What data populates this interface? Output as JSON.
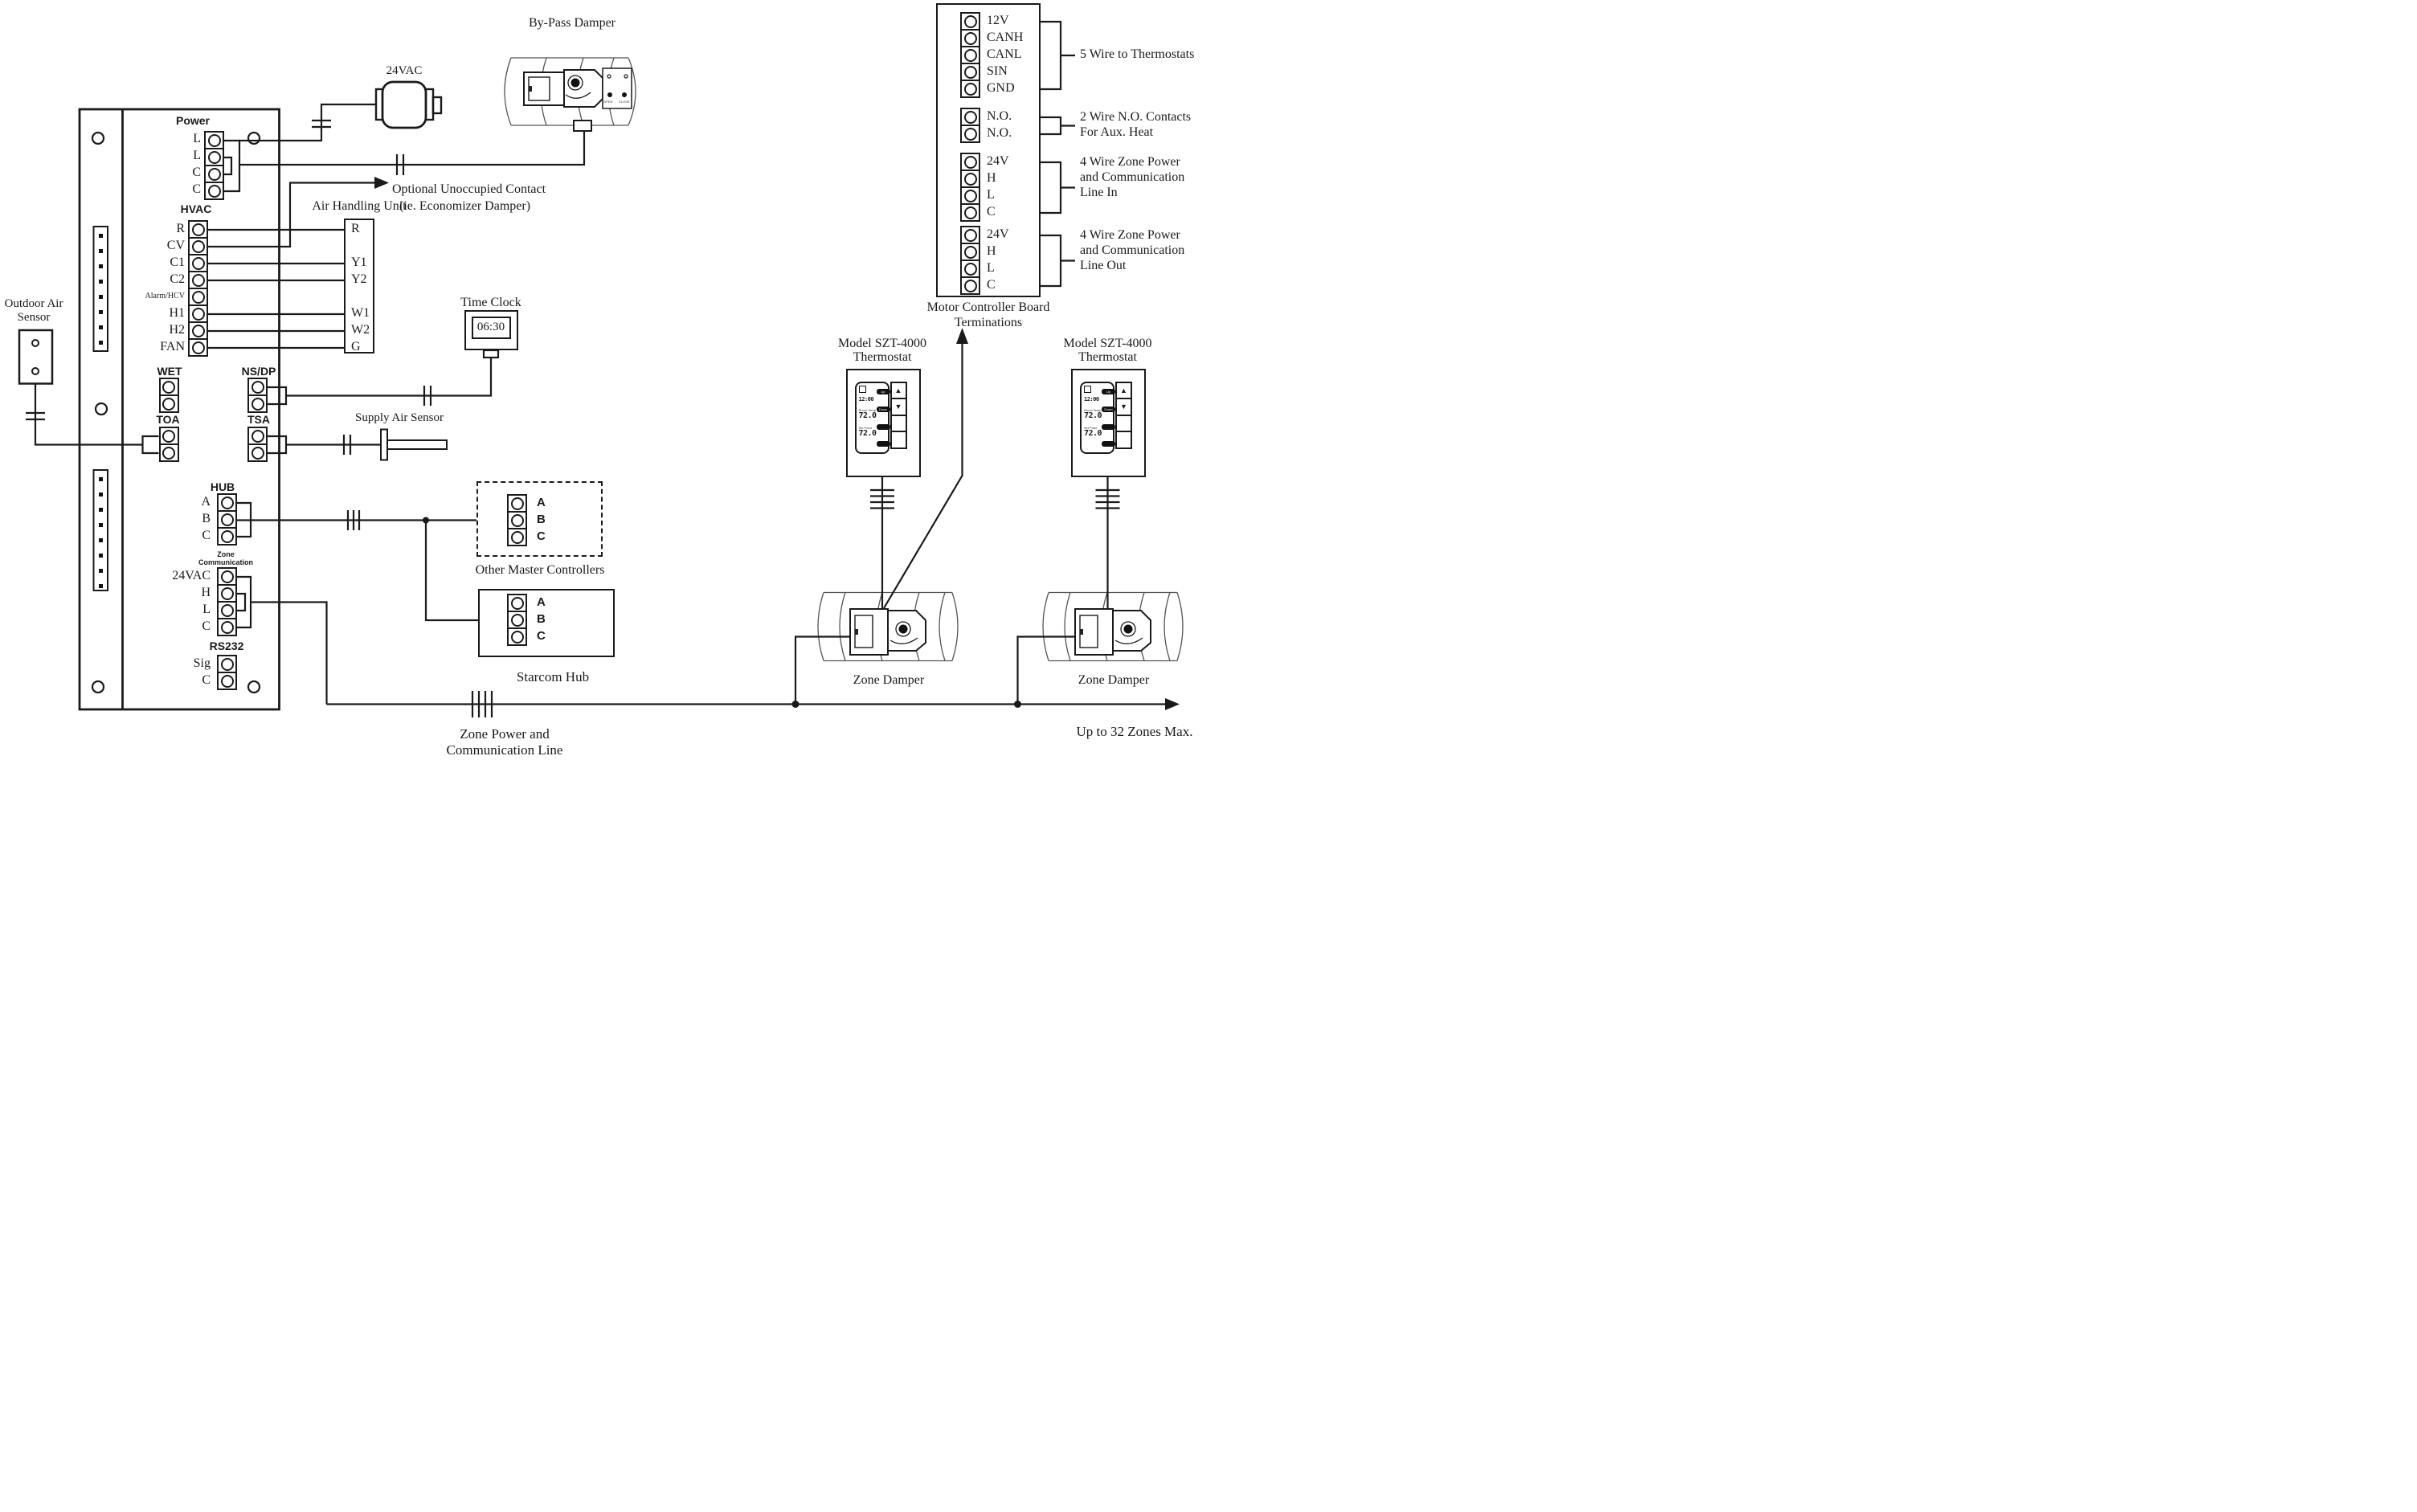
{
  "board": {
    "power": {
      "header": "Power",
      "rows": [
        "L",
        "L",
        "C",
        "C"
      ]
    },
    "hvac": {
      "header": "HVAC",
      "rows": [
        "R",
        "CV",
        "C1",
        "C2",
        "Alarm/HCV",
        "H1",
        "H2",
        "FAN"
      ]
    },
    "wet": {
      "header": "WET"
    },
    "toa": {
      "header": "TOA"
    },
    "nsdp": {
      "header": "NS/DP"
    },
    "tsa": {
      "header": "TSA"
    },
    "hub": {
      "header": "HUB",
      "rows": [
        "A",
        "B",
        "C"
      ]
    },
    "zone_comm": {
      "header_line1": "Zone",
      "header_line2": "Communication",
      "rows": [
        "24VAC",
        "H",
        "L",
        "C"
      ]
    },
    "rs232": {
      "header": "RS232",
      "rows": [
        "Sig",
        "C"
      ]
    }
  },
  "transformer": {
    "label": "24VAC"
  },
  "bypass_damper": {
    "label": "By-Pass Damper",
    "open_label": "OPEN",
    "close_label": "CLOSE"
  },
  "optional_contact": {
    "line1": "Optional Unoccupied Contact",
    "line2": "(ie. Economizer Damper)"
  },
  "ahu": {
    "label": "Air Handling Unit",
    "rows": [
      "R",
      "Y1",
      "Y2",
      "W1",
      "W2",
      "G"
    ]
  },
  "time_clock": {
    "label": "Time Clock",
    "display": "06:30"
  },
  "outdoor_sensor": {
    "line1": "Outdoor Air",
    "line2": "Sensor"
  },
  "supply_sensor": {
    "label": "Supply Air Sensor"
  },
  "other_masters": {
    "label": "Other Master Controllers",
    "rows": [
      "A",
      "B",
      "C"
    ]
  },
  "starcom": {
    "label": "Starcom Hub",
    "rows": [
      "A",
      "B",
      "C"
    ]
  },
  "motor_board": {
    "label_line1": "Motor Controller Board",
    "label_line2": "Terminations",
    "group1": {
      "rows": [
        "12V",
        "CANH",
        "CANL",
        "SIN",
        "GND"
      ],
      "note": "5 Wire to Thermostats"
    },
    "group2": {
      "rows": [
        "N.O.",
        "N.O."
      ],
      "note_line1": "2 Wire N.O. Contacts",
      "note_line2": "For Aux. Heat"
    },
    "group3": {
      "rows": [
        "24V",
        "H",
        "L",
        "C"
      ],
      "note_line1": "4 Wire Zone Power",
      "note_line2": "and Communication",
      "note_line3": "Line In"
    },
    "group4": {
      "rows": [
        "24V",
        "H",
        "L",
        "C"
      ],
      "note_line1": "4 Wire Zone Power",
      "note_line2": "and Communication",
      "note_line3": "Line Out"
    }
  },
  "thermostat1": {
    "label_line1": "Model SZT-4000",
    "label_line2": "Thermostat",
    "time": "12:00",
    "room_temp_label": "Room Temp",
    "room_temp": "72.0",
    "set_point_label": "Set Point",
    "set_point": "72.0",
    "btn_up": "Up",
    "btn_down": "Down",
    "arrow_up": "▲",
    "arrow_down": "▼"
  },
  "thermostat2": {
    "label_line1": "Model SZT-4000",
    "label_line2": "Thermostat",
    "time": "12:00",
    "room_temp_label": "Room Temp",
    "room_temp": "72.0",
    "set_point_label": "Set Point",
    "set_point": "72.0",
    "btn_up": "Up",
    "btn_down": "Down",
    "arrow_up": "▲",
    "arrow_down": "▼"
  },
  "zone_damper1": {
    "label": "Zone Damper"
  },
  "zone_damper2": {
    "label": "Zone Damper"
  },
  "bottom": {
    "zone_power_line1": "Zone Power and",
    "zone_power_line2": "Communication Line",
    "max_zones": "Up to 32 Zones Max."
  }
}
